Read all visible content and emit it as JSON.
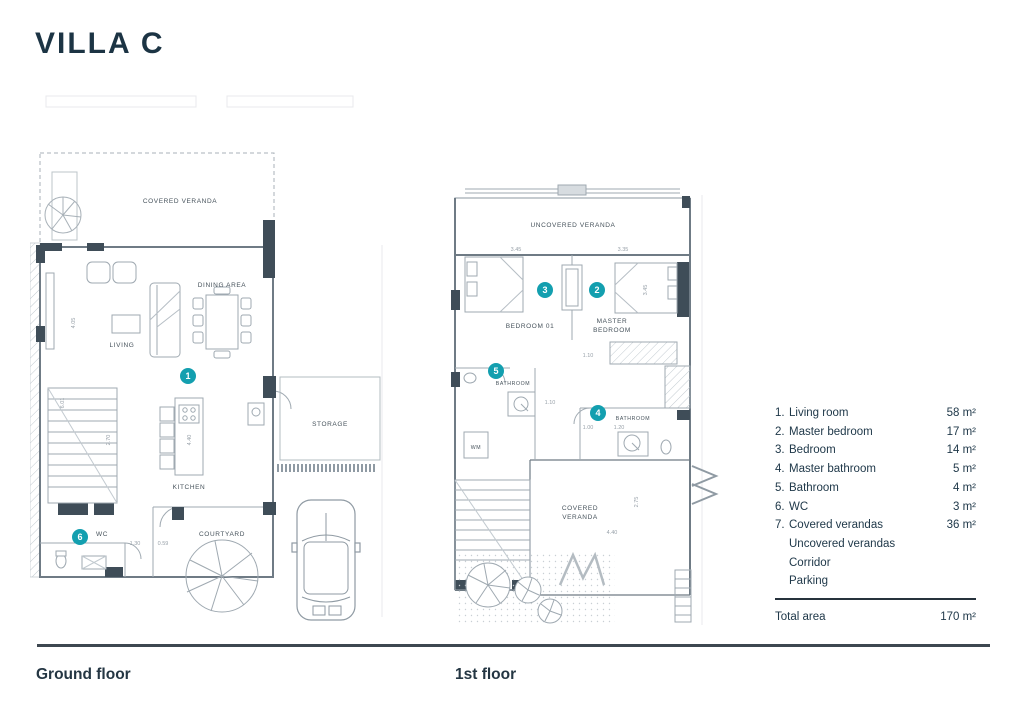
{
  "title": "VILLA C",
  "colors": {
    "accent": "#139faf",
    "ink": "#1e3848",
    "wall": "#3f4d58"
  },
  "footer": {
    "ground_caption": "Ground floor",
    "first_caption": "1st floor"
  },
  "legend": {
    "items": [
      {
        "num": "1.",
        "label": "Living room",
        "area": "58 m²"
      },
      {
        "num": "2.",
        "label": "Master bedroom",
        "area": "17 m²"
      },
      {
        "num": "3.",
        "label": "Bedroom",
        "area": "14 m²"
      },
      {
        "num": "4.",
        "label": "Master bathroom",
        "area": "5 m²"
      },
      {
        "num": "5.",
        "label": "Bathroom",
        "area": "4 m²"
      },
      {
        "num": "6.",
        "label": "WC",
        "area": "3 m²"
      },
      {
        "num": "7.",
        "label": "Covered verandas",
        "area": "36 m²"
      },
      {
        "num": "",
        "label": "Uncovered verandas",
        "area": ""
      },
      {
        "num": "",
        "label": "Corridor",
        "area": ""
      },
      {
        "num": "",
        "label": "Parking",
        "area": ""
      }
    ],
    "total_label": "Total area",
    "total_value": "170 m²"
  },
  "ground_floor": {
    "labels": {
      "covered_veranda": "COVERED VERANDA",
      "living": "LIVING",
      "dining": "DINING AREA",
      "kitchen": "KITCHEN",
      "storage": "STORAGE",
      "wc": "WC",
      "courtyard": "COURTYARD"
    },
    "dims": {
      "kitchen": "4.40",
      "stairs": "2.70",
      "wc_a": "1.30",
      "wc_b": "0.59",
      "left_v1": "4.05",
      "left_v2": "6.01"
    },
    "badges": {
      "living": "1",
      "wc": "6"
    }
  },
  "first_floor": {
    "labels": {
      "uncovered_veranda": "UNCOVERED VERANDA",
      "bedroom01": "BEDROOM 01",
      "master_l1": "MASTER",
      "master_l2": "BEDROOM",
      "bathroom_small": "BATHROOM",
      "bathroom_master": "BATHROOM",
      "wm": "WM",
      "covered_l1": "COVERED",
      "covered_l2": "VERANDA"
    },
    "dims": {
      "bed1": "3.45",
      "bed2": "3.35",
      "bed2_v": "3.45",
      "corridor": "1.10",
      "bath_small": "1.10",
      "bath_a": "1.00",
      "bath_b": "1.20",
      "veranda_w": "4.40",
      "veranda_h": "2.75"
    },
    "badges": {
      "bedroom": "3",
      "master_bedroom": "2",
      "bathroom": "5",
      "master_bathroom": "4"
    }
  }
}
